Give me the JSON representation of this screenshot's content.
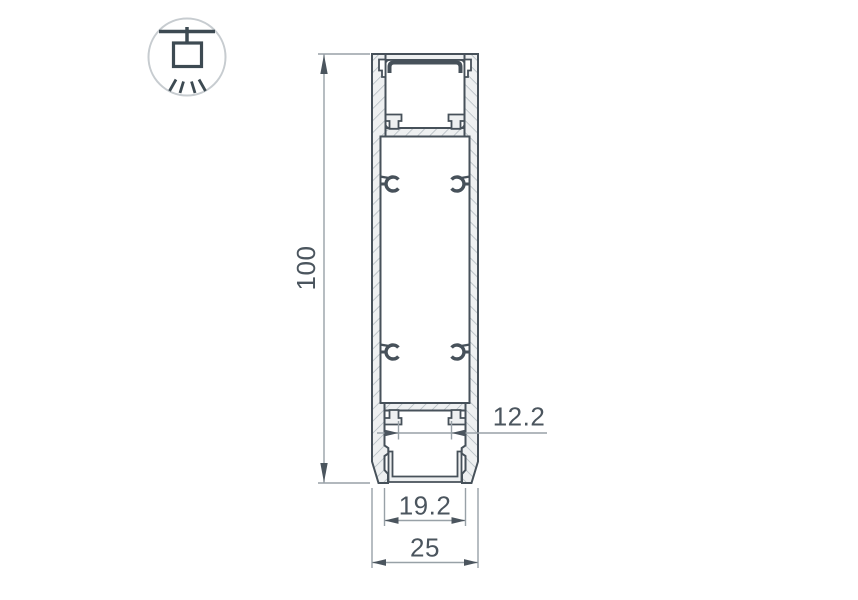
{
  "page": {
    "background": "#ffffff"
  },
  "badge": {
    "icon": "ceiling-pendant-light-icon"
  },
  "drawing": {
    "subject": "aluminium LED profile cross-section",
    "dimensions": {
      "height": {
        "value": "100",
        "orientation": "vertical"
      },
      "slot_width": {
        "value": "12.2",
        "orientation": "horizontal"
      },
      "channel_width": {
        "value": "19.2",
        "orientation": "horizontal"
      },
      "overall_width": {
        "value": "25",
        "orientation": "horizontal"
      }
    },
    "colors": {
      "outline": "#47515a",
      "material_fill": "#eef0f1",
      "hatch_line": "#aab3b9",
      "dimension_line": "#98a1a7",
      "dimension_text": "#4b555e",
      "icon_glyph": "#3d4a52",
      "icon_circle": "#c7ccd0"
    }
  }
}
